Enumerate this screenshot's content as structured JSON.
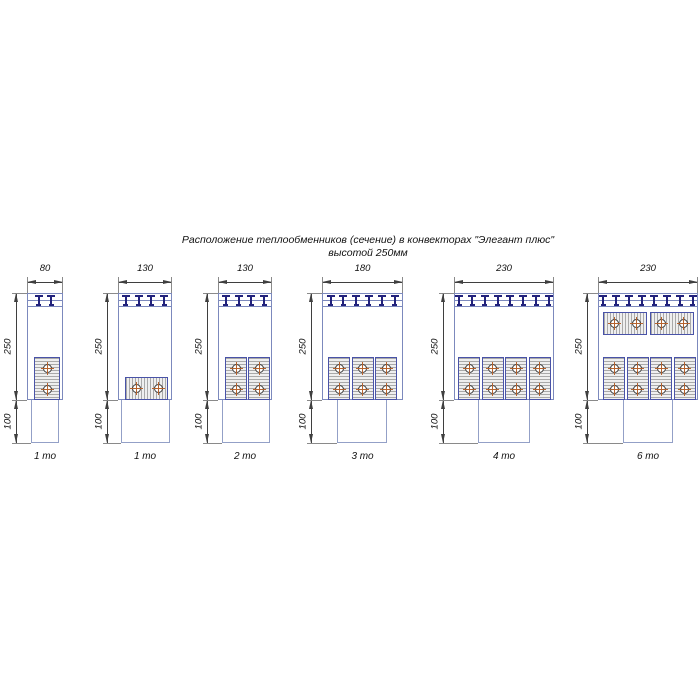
{
  "title": {
    "line1": "Расположение теплообменников (сечение) в конвекторах \"Элегант плюс\"",
    "line2": "высотой 250мм"
  },
  "dim_labels": {
    "height": "250",
    "base": "100"
  },
  "colors": {
    "outline": "#7c89bd",
    "outline_light": "#93a0c7",
    "hx_border": "#4953a8",
    "navy": "#22227c",
    "hatch_line": "#a9a9a9",
    "hatch_bg": "#efefef",
    "dim_line": "#3f3f3f",
    "witness": "#8a8a8a",
    "cross": "#b5622d",
    "circle_border": "#3a3a3a",
    "text": "#111111"
  },
  "diagrams": [
    {
      "width_label": "80",
      "caption": "1 то",
      "left": 27,
      "body_w": 36,
      "brackets": 2,
      "pedestal": {
        "x": 4,
        "w": 28
      },
      "exchangers": [
        {
          "x": 7,
          "y": 64,
          "w": 26,
          "h": 43,
          "dir": "v",
          "circles": [
            [
              20,
              75
            ],
            [
              20,
              96
            ]
          ]
        }
      ]
    },
    {
      "width_label": "130",
      "caption": "1 то",
      "left": 118,
      "body_w": 54,
      "brackets": 4,
      "pedestal": {
        "x": 3,
        "w": 49
      },
      "exchangers": [
        {
          "x": 7,
          "y": 84,
          "w": 43,
          "h": 23,
          "dir": "h",
          "circles": [
            [
              18,
              95
            ],
            [
              40,
              95
            ]
          ]
        }
      ]
    },
    {
      "width_label": "130",
      "caption": "2 то",
      "left": 218,
      "body_w": 54,
      "brackets": 4,
      "pedestal": {
        "x": 4,
        "w": 48
      },
      "exchangers": [
        {
          "x": 7,
          "y": 64,
          "w": 22,
          "h": 43,
          "dir": "v",
          "circles": [
            [
              18,
              75
            ],
            [
              18,
              96
            ]
          ]
        },
        {
          "x": 30,
          "y": 64,
          "w": 22,
          "h": 43,
          "dir": "v",
          "circles": [
            [
              41,
              75
            ],
            [
              41,
              96
            ]
          ]
        }
      ]
    },
    {
      "width_label": "180",
      "caption": "3 то",
      "left": 322,
      "body_w": 81,
      "brackets": 6,
      "pedestal": {
        "x": 15,
        "w": 50
      },
      "exchangers": [
        {
          "x": 6,
          "y": 64,
          "w": 22,
          "h": 43,
          "dir": "v",
          "circles": [
            [
              17,
              75
            ],
            [
              17,
              96
            ]
          ]
        },
        {
          "x": 29.5,
          "y": 64,
          "w": 22,
          "h": 43,
          "dir": "v",
          "circles": [
            [
              40.5,
              75
            ],
            [
              40.5,
              96
            ]
          ]
        },
        {
          "x": 53,
          "y": 64,
          "w": 22,
          "h": 43,
          "dir": "v",
          "circles": [
            [
              64,
              75
            ],
            [
              64,
              96
            ]
          ]
        }
      ]
    },
    {
      "width_label": "230",
      "caption": "4 то",
      "left": 454,
      "body_w": 100,
      "brackets": 8,
      "pedestal": {
        "x": 24,
        "w": 52
      },
      "exchangers": [
        {
          "x": 4,
          "y": 64,
          "w": 22,
          "h": 43,
          "dir": "v",
          "circles": [
            [
              15,
              75
            ],
            [
              15,
              96
            ]
          ]
        },
        {
          "x": 27.5,
          "y": 64,
          "w": 22,
          "h": 43,
          "dir": "v",
          "circles": [
            [
              38.5,
              75
            ],
            [
              38.5,
              96
            ]
          ]
        },
        {
          "x": 51,
          "y": 64,
          "w": 22,
          "h": 43,
          "dir": "v",
          "circles": [
            [
              62,
              75
            ],
            [
              62,
              96
            ]
          ]
        },
        {
          "x": 74.5,
          "y": 64,
          "w": 22,
          "h": 43,
          "dir": "v",
          "circles": [
            [
              85.5,
              75
            ],
            [
              85.5,
              96
            ]
          ]
        }
      ]
    },
    {
      "width_label": "230",
      "caption": "6 то",
      "left": 598,
      "body_w": 100,
      "brackets": 8,
      "pedestal": {
        "x": 25,
        "w": 50
      },
      "exchangers": [
        {
          "x": 5,
          "y": 19,
          "w": 44,
          "h": 23,
          "dir": "h",
          "circles": [
            [
              16,
              30.5
            ],
            [
              38,
              30.5
            ]
          ]
        },
        {
          "x": 52,
          "y": 19,
          "w": 44,
          "h": 23,
          "dir": "h",
          "circles": [
            [
              63,
              30.5
            ],
            [
              85,
              30.5
            ]
          ]
        },
        {
          "x": 5,
          "y": 64,
          "w": 22,
          "h": 43,
          "dir": "v",
          "circles": [
            [
              16,
              75
            ],
            [
              16,
              96
            ]
          ]
        },
        {
          "x": 28.5,
          "y": 64,
          "w": 22,
          "h": 43,
          "dir": "v",
          "circles": [
            [
              39.5,
              75
            ],
            [
              39.5,
              96
            ]
          ]
        },
        {
          "x": 52,
          "y": 64,
          "w": 22,
          "h": 43,
          "dir": "v",
          "circles": [
            [
              63,
              75
            ],
            [
              63,
              96
            ]
          ]
        },
        {
          "x": 75.5,
          "y": 64,
          "w": 22,
          "h": 43,
          "dir": "v",
          "circles": [
            [
              86.5,
              75
            ],
            [
              86.5,
              96
            ]
          ]
        }
      ]
    }
  ]
}
